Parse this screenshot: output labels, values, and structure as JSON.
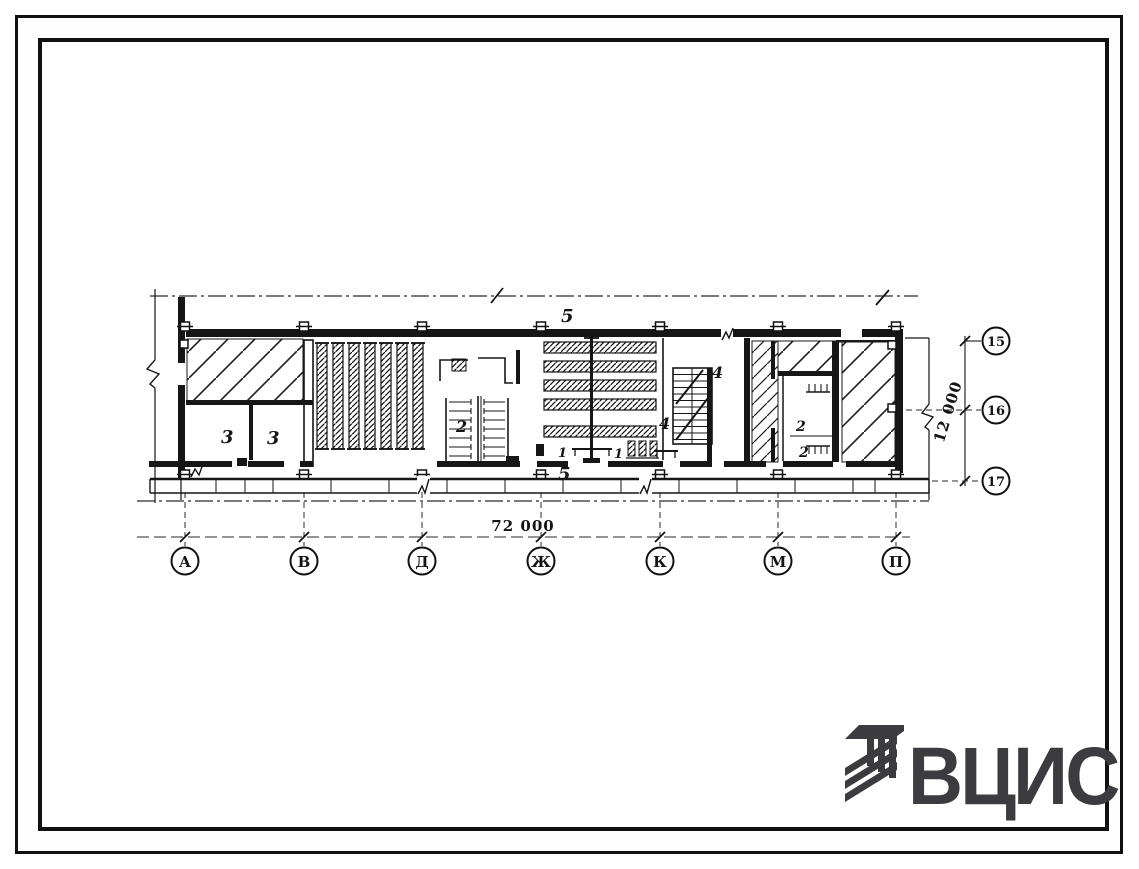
{
  "drawing": {
    "type": "floor-plan",
    "room_labels": [
      {
        "text": "5"
      },
      {
        "text": "5"
      },
      {
        "text": "3"
      },
      {
        "text": "3"
      },
      {
        "text": "2"
      },
      {
        "text": "4"
      },
      {
        "text": "4"
      },
      {
        "text": "2"
      },
      {
        "text": "2"
      },
      {
        "text": "1"
      },
      {
        "text": "1"
      }
    ],
    "dimensions": {
      "bottom_total": "72 000",
      "right_total": "12 000"
    },
    "axes_bottom": [
      {
        "label": "А"
      },
      {
        "label": "В"
      },
      {
        "label": "Д"
      },
      {
        "label": "Ж"
      },
      {
        "label": "К"
      },
      {
        "label": "М"
      },
      {
        "label": "П"
      }
    ],
    "axes_right": [
      {
        "label": "15"
      },
      {
        "label": "16"
      },
      {
        "label": "17"
      }
    ]
  },
  "logo": {
    "text": "ВЦИС",
    "color": "#3b3b40"
  }
}
